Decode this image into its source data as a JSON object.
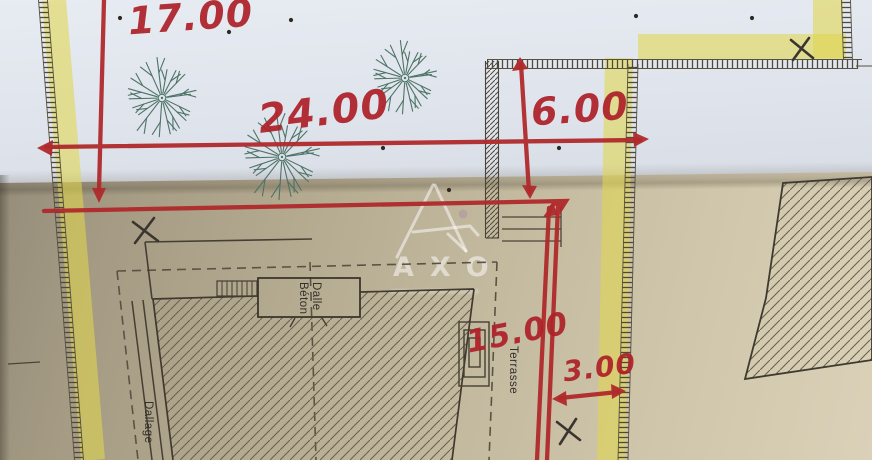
{
  "dims": {
    "left": "17.00",
    "width": "24.00",
    "depth": "6.00",
    "side": "15.00",
    "offset": "3.00"
  },
  "labels": {
    "dalle_line1": "Dalle",
    "dalle_line2": "Béton",
    "terrasse": "Terrasse",
    "dallage": "Dallage"
  },
  "watermark": {
    "letters": "AXO"
  },
  "colors": {
    "red_pen": "#ae2129",
    "highlighter": "#e0d64e",
    "tree_green": "#4d7366",
    "plan_line": "#453f33",
    "paper_top": "#e2e7ee",
    "paper_bottom": "#c9bfa4"
  },
  "plan": {
    "trees": [
      {
        "cx": 162,
        "cy": 98,
        "r": 40
      },
      {
        "cx": 405,
        "cy": 78,
        "r": 37
      },
      {
        "cx": 282,
        "cy": 157,
        "r": 44
      }
    ],
    "dots": [
      [
        120,
        18
      ],
      [
        229,
        32
      ],
      [
        291,
        20
      ],
      [
        383,
        148
      ],
      [
        559,
        148
      ],
      [
        636,
        16
      ],
      [
        752,
        18
      ],
      [
        449,
        190
      ]
    ]
  }
}
